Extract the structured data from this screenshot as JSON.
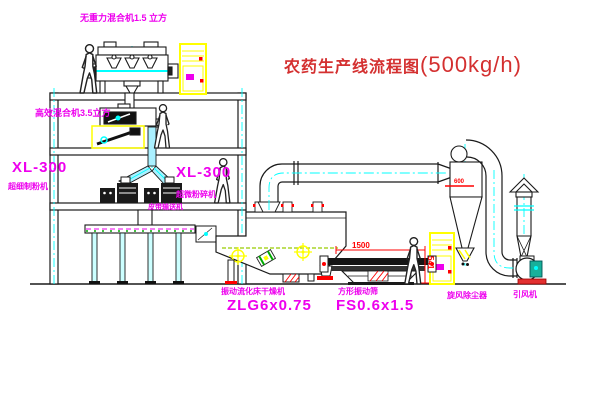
{
  "title": {
    "main": "农药生产线流程图",
    "capacity": "(500kg/h)"
  },
  "labels": {
    "gravity_mixer": "无重力混合机1.5 立方",
    "high_eff_mixer": "高效混合机3.5立方",
    "mill_left_model": "XL-300",
    "mill_left_name": "超细制粉机",
    "mill_right_model": "XL-300",
    "mill_right_name": "超微粉碎机",
    "belt_conveyor": "皮带输送机",
    "dryer_name": "振动流化床干燥机",
    "dryer_model": "ZLG6x0.75",
    "screen_name": "方形振动筛",
    "screen_model": "FS0.6x1.5",
    "cyclone": "旋风除尘器",
    "fan": "引风机"
  },
  "dimensions": {
    "screen_length": "1500",
    "screen_height": "541",
    "cyclone_note": "600"
  },
  "colors": {
    "label": "#ee00ee",
    "title": "#d43030",
    "dimension": "#ff0000",
    "line": "#1a1a1a",
    "centerline": "#00ffff",
    "cabinet": "#ffff00"
  }
}
